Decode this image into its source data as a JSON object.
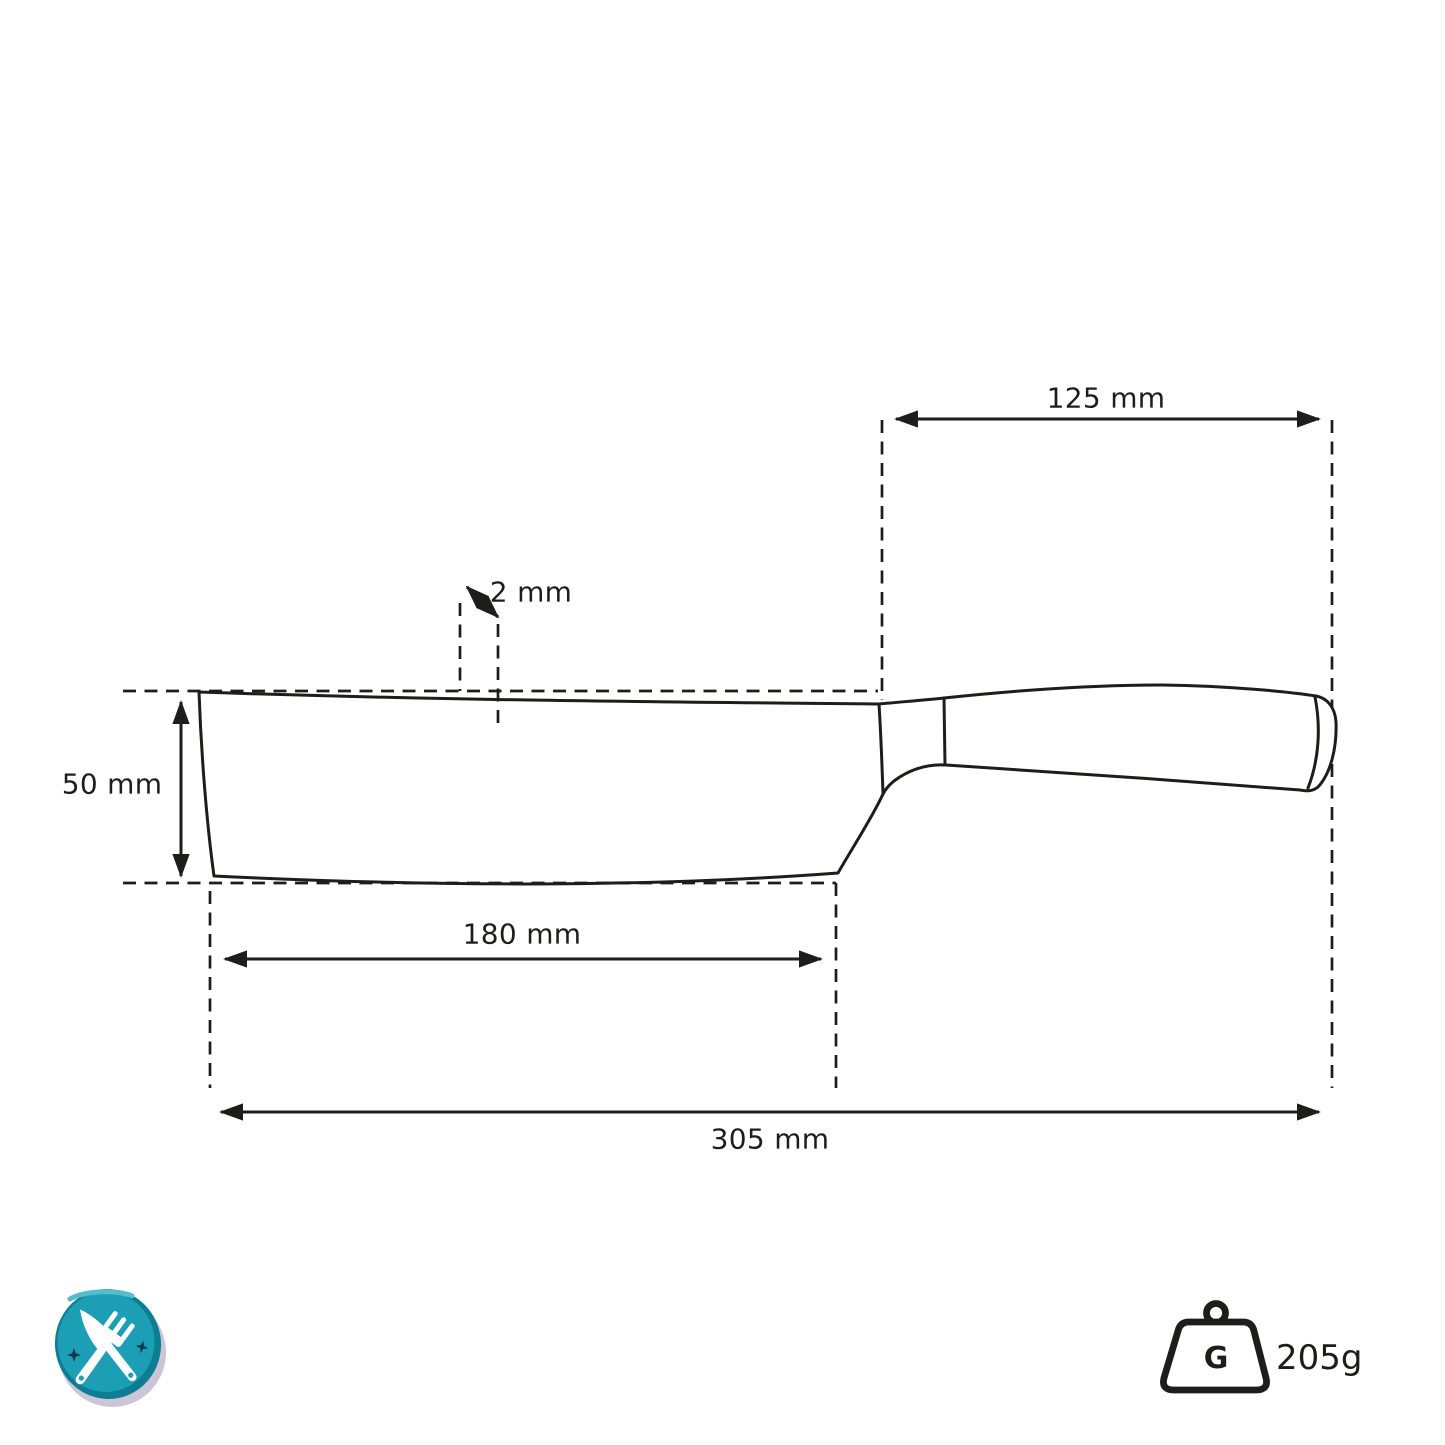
{
  "diagram": {
    "title": "knife-dimension-diagram",
    "product": "nakiri-style kitchen knife, side view technical drawing",
    "dimensions": {
      "handle_length": "125 mm",
      "spine_thickness": "2 mm",
      "blade_height": "50 mm",
      "blade_length": "180 mm",
      "total_length": "305 mm"
    },
    "weight": {
      "badge_letter": "G",
      "value": "205g"
    },
    "icons": {
      "food_badge": "crossed-knife-and-fork-badge",
      "weight_badge": "weight-kettlebell-icon"
    },
    "colors": {
      "line": "#1d1d1b",
      "badge_teal": "#1c9fb4",
      "badge_teal_dark": "#0c7d93",
      "badge_highlight": "#54bccb",
      "badge_star": "#14374f",
      "badge_shadow": "#cbc5d6",
      "utensil_white": "#ffffff"
    }
  }
}
